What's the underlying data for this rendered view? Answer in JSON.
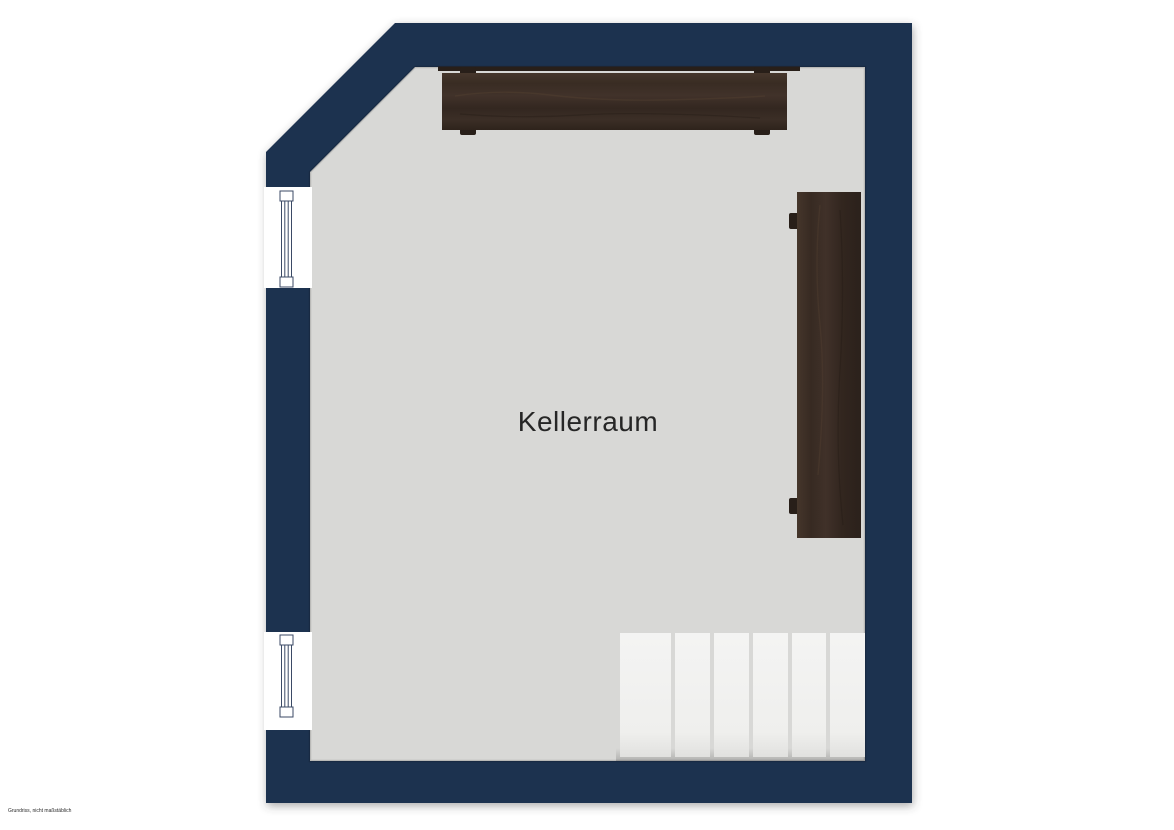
{
  "page": {
    "background": "#ffffff"
  },
  "floorplan": {
    "room": {
      "label": "Kellerraum"
    },
    "footnote": "Grundriss, nicht maßstäblich",
    "colors": {
      "page": "#ffffff",
      "wall": "#1e3150",
      "floor": "#d8d8d6",
      "step": "#f1f1f0",
      "step_shadow": "#c9c9c7",
      "window_frame": "#3b4a66",
      "wood": "#3a2d25",
      "wood_dark": "#281f19",
      "label_text": "#262626"
    },
    "elements": {
      "windows": [
        {
          "id": "window-upper-left",
          "wall": "left"
        },
        {
          "id": "window-lower-left",
          "wall": "left"
        }
      ],
      "furniture": [
        {
          "id": "sideboard-top-wall",
          "material": "dark-wood"
        },
        {
          "id": "shelf-right-wall",
          "material": "dark-wood"
        }
      ],
      "stairs": {
        "id": "staircase",
        "step_count": 6
      }
    }
  }
}
